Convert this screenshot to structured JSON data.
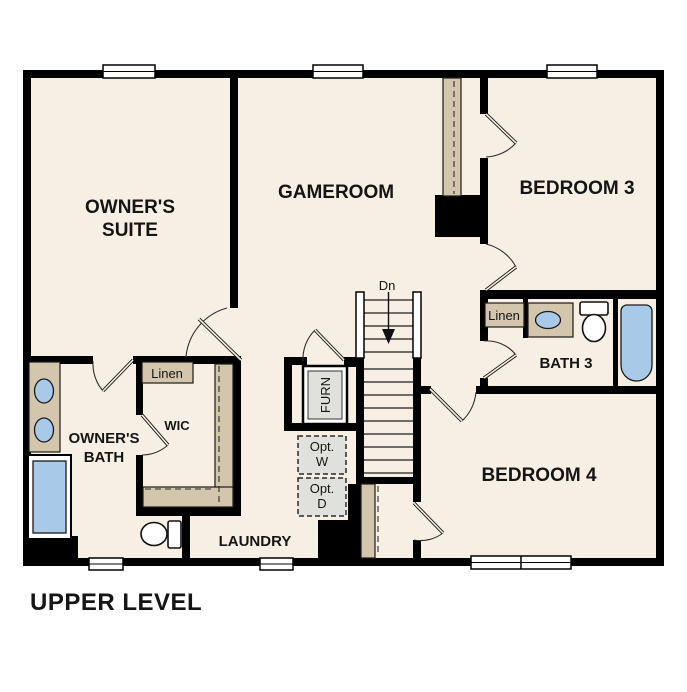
{
  "title": "UPPER LEVEL",
  "colors": {
    "floor": "#f7efe3",
    "wall": "#000000",
    "shelf_tan": "#d3c6ac",
    "fixture_blue": "#a9c9e9",
    "appliance_gray": "#e0e1dd",
    "text": "#151515"
  },
  "rooms": {
    "owners_suite": {
      "line1": "OWNER'S",
      "line2": "SUITE"
    },
    "gameroom": {
      "label": "GAMEROOM"
    },
    "bedroom3": {
      "label": "BEDROOM 3"
    },
    "bedroom4": {
      "label": "BEDROOM 4"
    },
    "bath3": {
      "label": "BATH 3"
    },
    "owners_bath": {
      "line1": "OWNER'S",
      "line2": "BATH"
    },
    "wic": {
      "label": "WIC"
    },
    "laundry": {
      "label": "LAUNDRY"
    }
  },
  "closets": {
    "linen_wic": "Linen",
    "linen_bath3": "Linen"
  },
  "stairs": {
    "down_label": "Dn"
  },
  "equipment": {
    "furnace": "FURN",
    "washer_opt_line1": "Opt.",
    "washer_opt_line2": "W",
    "dryer_opt_line1": "Opt.",
    "dryer_opt_line2": "D"
  }
}
